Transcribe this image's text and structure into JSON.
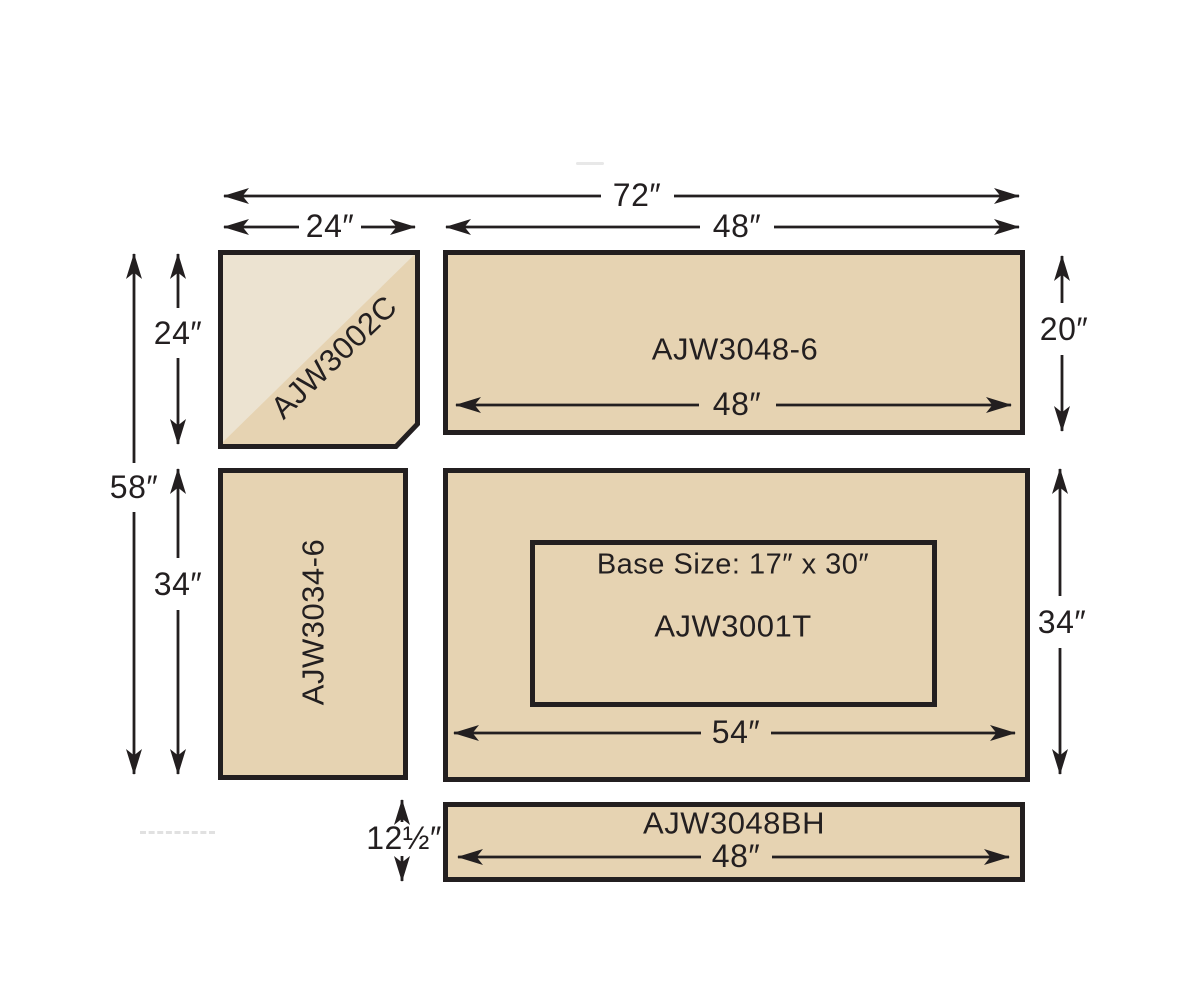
{
  "canvas": {
    "width": 1200,
    "height": 1000,
    "background": "#ffffff"
  },
  "palette": {
    "panel_fill": "#e6d3b2",
    "panel_fill_light": "#ece3d1",
    "ink": "#231f20"
  },
  "overall": {
    "width_dim": "72″",
    "height_dim": "58″"
  },
  "panels": {
    "corner": {
      "label": "AJW3002C",
      "width_dim": "24″",
      "height_dim": "24″"
    },
    "top": {
      "label": "AJW3048-6",
      "width_dim": "48″",
      "height_dim": "20″",
      "inner_width_dim": "48″"
    },
    "left": {
      "label": "AJW3034-6",
      "height_dim": "34″"
    },
    "center": {
      "label": "AJW3001T",
      "base_size": "Base Size: 17″ x 30″",
      "inner_width_dim": "54″",
      "height_dim": "34″"
    },
    "bottom": {
      "label": "AJW3048BH",
      "inner_width_dim": "48″",
      "height_dim": "12½″"
    }
  }
}
